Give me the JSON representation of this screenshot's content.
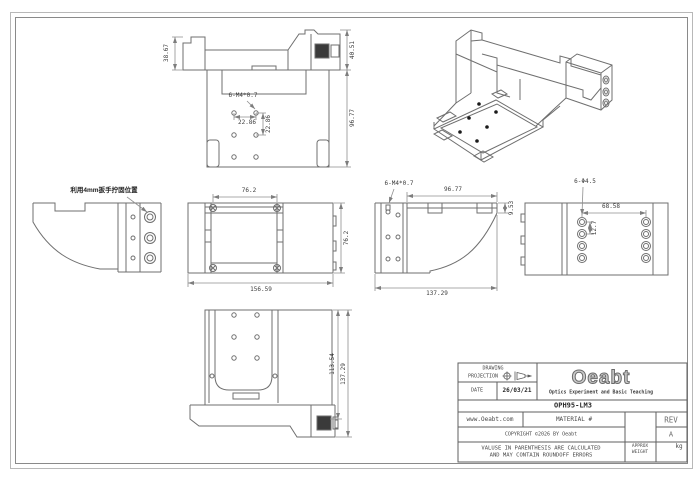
{
  "colors": {
    "background": "#ffffff",
    "outline": "#6f6f6f",
    "dimension": "#8f8f8f",
    "text": "#3c3c3c"
  },
  "annotations": {
    "wrench_note": "利用4mm扳手拧固位置"
  },
  "dimensions": {
    "top_view": {
      "left_height": "38.67",
      "right_height": "40.51",
      "body_height": "96.77",
      "thread_callout": "6-M4*0.7",
      "hole_pitch_x": "22.86",
      "hole_pitch_y": "22.86"
    },
    "front_view": {
      "rail_width": "76.2",
      "overall_width": "156.59",
      "overall_height": "76.2"
    },
    "side_view": {
      "thread_callout": "6-M4*0.7",
      "top_length": "96.77",
      "step_height": "9.53",
      "overall_length": "137.29"
    },
    "right_view": {
      "hole_callout": "6-Φ4.5",
      "hole_pitch_x": "68.58",
      "hole_pitch_y": "12.7"
    },
    "bottom_view": {
      "inner_depth": "113.54",
      "overall_depth": "137.29"
    }
  },
  "title_block": {
    "drawing_label": "DRAWING",
    "projection_label": "PROJECTION",
    "date_label": "DATE",
    "date_value": "26/03/21",
    "logo_text": "Oeabt",
    "logo_tagline": "Optics Experiment and Basic Teaching",
    "part_number": "OPH95-LM3",
    "website": "www.Oeabt.com",
    "material_label": "MATERIAL #",
    "rev_label": "REV",
    "rev_value": "A",
    "copyright": "COPYRIGHT ©2026 BY Oeabt",
    "disclaimer_line1": "VALUSE IN PARENTHESIS ARE CALCULATED",
    "disclaimer_line2": "AND MAY CONTAIN ROUNDOFF ERRORS",
    "approx_weight_label1": "APPROX",
    "approx_weight_label2": "WEIGHT",
    "weight_unit": "kg"
  }
}
